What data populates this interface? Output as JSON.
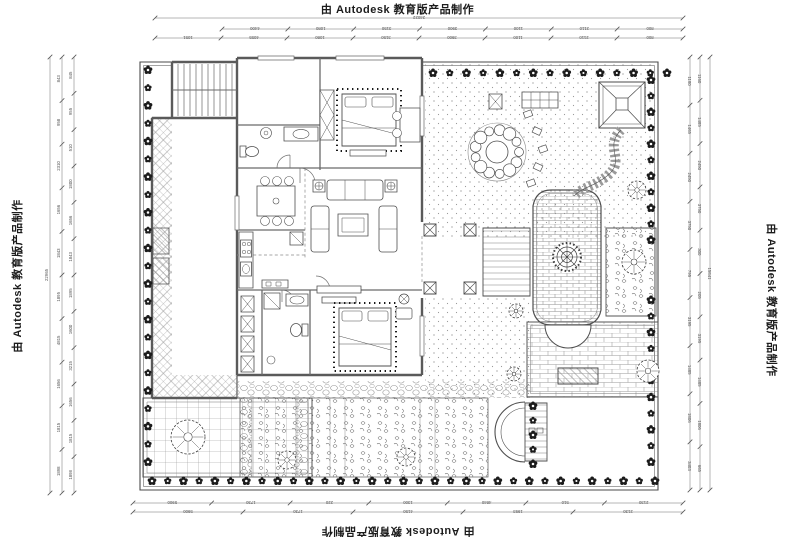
{
  "watermarks": {
    "top": "由 Autodesk 教育版产品制作",
    "bottom": "由 Autodesk 教育版产品制作",
    "left": "由 Autodesk 教育版产品制作",
    "right": "由 Autodesk 教育版产品制作"
  },
  "dimensions": {
    "top": {
      "overall": "24022",
      "row1": [
        "4400",
        "1080",
        "3150",
        "3900",
        "1100",
        "2110",
        "800"
      ],
      "row2": [
        "1051",
        "4055",
        "1080",
        "3150",
        "3900",
        "1100",
        "2110",
        "800"
      ]
    },
    "bottom": {
      "row1": [
        "5900",
        "1730",
        "220",
        "1300",
        "4840",
        "510",
        "2130"
      ],
      "row2": [
        "5900",
        "1730",
        "4150",
        "1993",
        "2130"
      ]
    },
    "left": {
      "overall": "22965",
      "row1": [
        "843",
        "958",
        "2310",
        "1656",
        "1843",
        "1895",
        "4815",
        "1656",
        "1815",
        "1898"
      ],
      "row2": [
        "845",
        "955",
        "510",
        "1800",
        "1656",
        "1843",
        "1895",
        "1600",
        "3215",
        "1656",
        "1815",
        "1898"
      ]
    },
    "right": {
      "overall": "15841",
      "row1": [
        "1180",
        "1465",
        "2450",
        "3750",
        "795",
        "3195",
        "1485",
        "1806",
        "3403"
      ],
      "row2": [
        "1160",
        "1485",
        "2450",
        "3750",
        "300",
        "205",
        "3195",
        "1485",
        "1806",
        "665"
      ]
    }
  },
  "colors": {
    "background": "#ffffff",
    "line": "#4b4b4b",
    "wall": "#5a5a5a",
    "dim": "#6e6e6e",
    "flower": "#1b1b1b",
    "watermark": "#1c1c1c"
  }
}
